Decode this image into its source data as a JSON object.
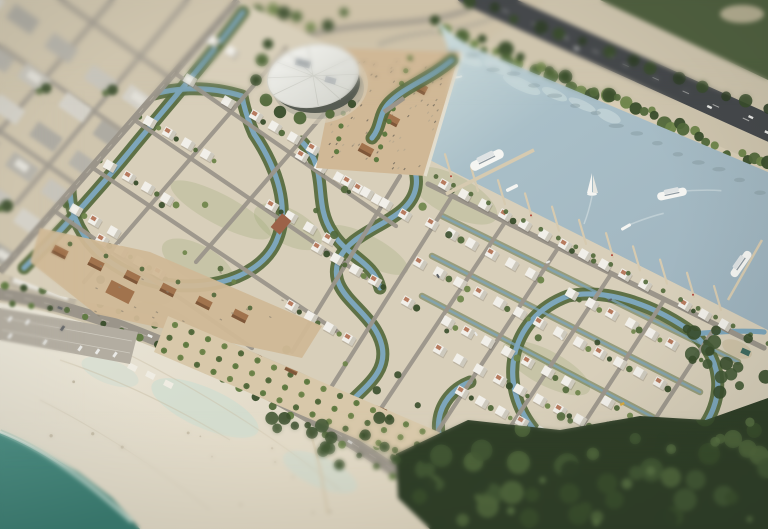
{
  "scene": {
    "description": "Tilt-shift aerial architectural rendering of a coastal villa community with winding canals, a marina lagoon with boats, a circular landmark building, souk retail strip, orchard promenade, mangrove forest and a wide public beach",
    "style": "aerial-render",
    "palette": {
      "ground": "#cfc5ae",
      "ground_light": "#d8cfba",
      "city_block": "#b6b3aa",
      "city_block_light": "#c9c6bd",
      "city_road": "#a19b90",
      "road": "#9b958a",
      "road_light": "#b3ada1",
      "asphalt": "#45484b",
      "lane_mark": "#d9d9d4",
      "sea": "#4f9186",
      "sea_deep": "#3a7c71",
      "sea_foam": "#e8efe8",
      "beach_sand": "#eae6d9",
      "beach_sand_warm": "#ddd3bd",
      "wet_sand": "#c9dcd2",
      "lagoon": "#a9bfc8",
      "lagoon_shallow": "#cfdedd",
      "canal": "#7da6bb",
      "canal_bank_green": "#55693c",
      "tree_dark": "#394d2b",
      "tree_mid": "#51683a",
      "tree_light": "#6d8449",
      "palm": "#5f7a40",
      "forest_dark": "#2f3e27",
      "forest_mid": "#435834",
      "villa": "#f1efe9",
      "villa_shadow": "#c9c4b8",
      "roof_terracotta": "#b06e50",
      "souk_brown": "#a1734d",
      "souk_brown_dark": "#7e5739",
      "plaza_sand": "#d0b896",
      "band_sand": "#d8c8aa",
      "plaza_speck": "#8f8472",
      "dome_roof": "#eeeeea",
      "dome_glass": "#565b52",
      "pier": "#d6cab0",
      "boat_white": "#f5f5f2",
      "boat_trim": "#8d98a0",
      "car_white": "#e9e9e6",
      "car_dark": "#5a5e62",
      "taxi_yellow": "#d8a93c"
    },
    "landmarks": [
      {
        "name": "existing-city-blocks"
      },
      {
        "name": "circular-landmark-building"
      },
      {
        "name": "event-plaza"
      },
      {
        "name": "villa-district"
      },
      {
        "name": "canal-network"
      },
      {
        "name": "marina-lagoon"
      },
      {
        "name": "marina-piers"
      },
      {
        "name": "coastal-highway"
      },
      {
        "name": "souk-retail-village"
      },
      {
        "name": "orchard-promenade"
      },
      {
        "name": "mangrove-forest"
      },
      {
        "name": "public-beach"
      },
      {
        "name": "beach-jetty"
      },
      {
        "name": "beach-parking"
      },
      {
        "name": "sea"
      }
    ],
    "boats": [
      {
        "name": "docked-yacht",
        "x": 487,
        "y": 160,
        "angle": -26,
        "length": 36
      },
      {
        "name": "runabout",
        "x": 512,
        "y": 188,
        "angle": -26,
        "length": 13
      },
      {
        "name": "sailboat",
        "x": 592,
        "y": 187,
        "angle": 0,
        "length": 10
      },
      {
        "name": "cruising-yacht",
        "x": 672,
        "y": 194,
        "angle": -12,
        "length": 30
      },
      {
        "name": "small-boat",
        "x": 626,
        "y": 227,
        "angle": -30,
        "length": 11
      },
      {
        "name": "moored-yacht",
        "x": 741,
        "y": 264,
        "angle": -55,
        "length": 30
      }
    ]
  }
}
